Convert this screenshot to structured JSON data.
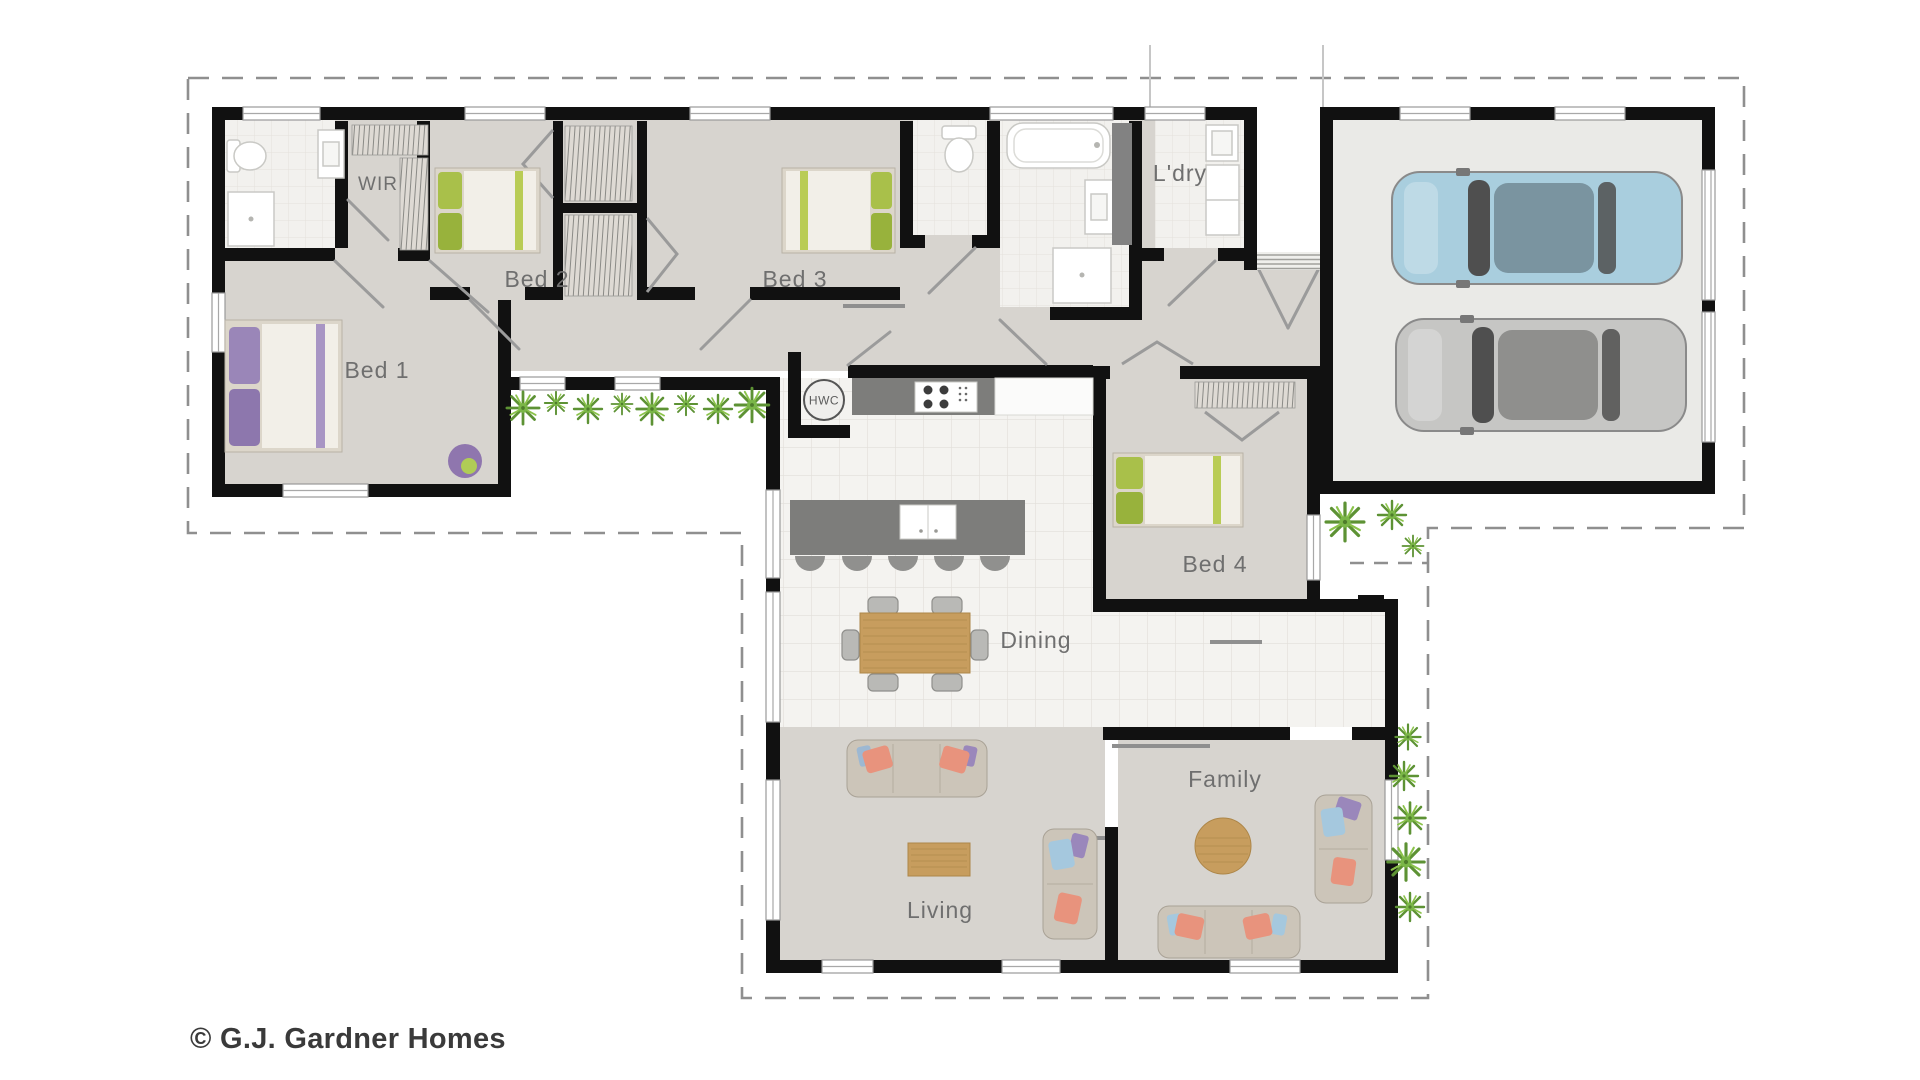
{
  "floorplan": {
    "labels": {
      "wir": "WIR",
      "bed1": "Bed 1",
      "bed2": "Bed 2",
      "bed3": "Bed 3",
      "bed4": "Bed 4",
      "laundry": "L'dry",
      "hwc": "HWC",
      "dining": "Dining",
      "living": "Living",
      "family": "Family"
    },
    "copyright": "© G.J. Gardner Homes",
    "colors": {
      "wall": "#111111",
      "floor_gray": "#d7d4cf",
      "tile": "#f4f3f0",
      "tile_line": "#e2dfda",
      "garage_floor": "#eaeae7",
      "counter_dark": "#7d7d7b",
      "wood": "#c79d5e",
      "label_gray": "#6f6f6f",
      "boundary_dash": "#8f8f8f",
      "car_blue": "#a9cede",
      "car_gray": "#c6c6c4",
      "plant_green": "#7ab648",
      "pillow_salmon": "#e8937d",
      "pillow_blue": "#a5c8de",
      "pillow_purple": "#9a87bb",
      "linen_green": "#a9c04a"
    }
  }
}
